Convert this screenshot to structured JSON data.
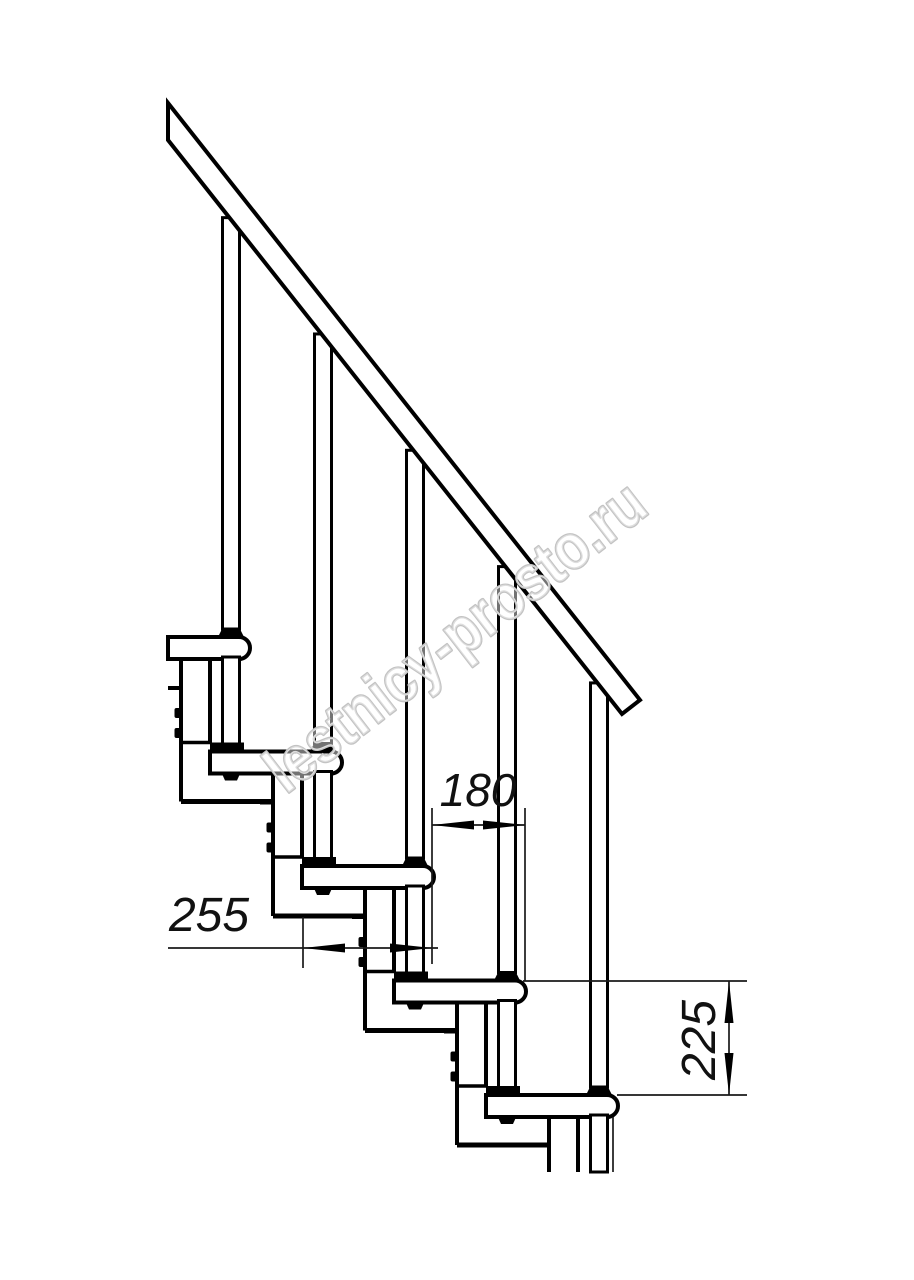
{
  "drawing": {
    "dimensions": [
      {
        "name": "step-run",
        "value": "180"
      },
      {
        "name": "module-depth",
        "value": "255"
      },
      {
        "name": "step-rise",
        "value": "225"
      }
    ],
    "watermark": {
      "text": "lestnicy-prosto.ru",
      "color": "#c3c3c3"
    }
  }
}
